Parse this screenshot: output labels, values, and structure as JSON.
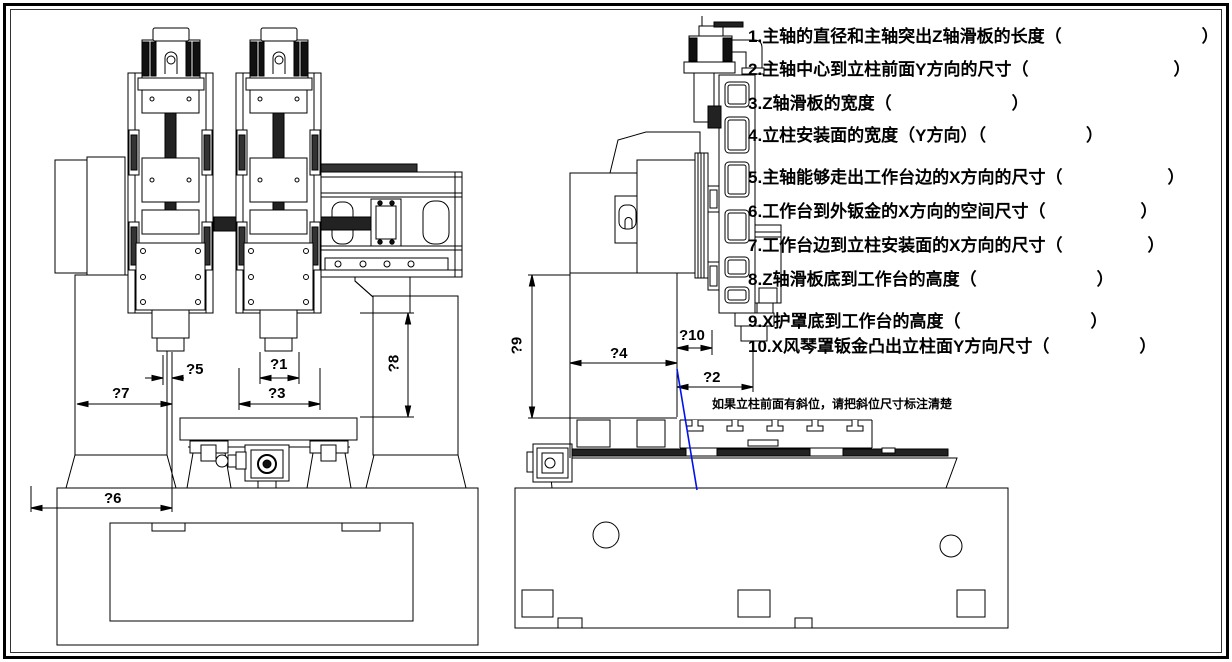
{
  "drawing": {
    "note": "如果立柱前面有斜位，请把斜位尺寸标注清楚",
    "line_color": "#000000",
    "slope_line_color": "#0011ee",
    "background": "#ffffff"
  },
  "questions": {
    "items": [
      {
        "num": "1.",
        "text": "主轴的直径和主轴突出Z轴滑板的长度",
        "open": "（",
        "close": "）"
      },
      {
        "num": "2.",
        "text": "主轴中心到立柱前面Y方向的尺寸",
        "open": "（",
        "close": "）"
      },
      {
        "num": "3.",
        "text": "Z轴滑板的宽度",
        "open": "（",
        "close": "）"
      },
      {
        "num": "4.",
        "text": "立柱安装面的宽度（Y方向）",
        "open": "（",
        "close": "）"
      },
      {
        "num": "5.",
        "text": "主轴能够走出工作台边的X方向的尺寸",
        "open": "（",
        "close": "）"
      },
      {
        "num": "6.",
        "text": "工作台到外钣金的X方向的空间尺寸",
        "open": "（",
        "close": "）"
      },
      {
        "num": "7.",
        "text": "工作台边到立柱安装面的X方向的尺寸",
        "open": "（",
        "close": "）"
      },
      {
        "num": "8.",
        "text": "Z轴滑板底到工作台的高度",
        "open": "（",
        "close": "）"
      },
      {
        "num": "9.",
        "text": "X护罩底到工作台的高度",
        "open": "（",
        "close": "）"
      },
      {
        "num": "10.",
        "text": "X风琴罩钣金凸出立柱面Y方向尺寸",
        "open": "（",
        "close": "）"
      }
    ]
  },
  "dims": {
    "d1": "?1",
    "d2": "?2",
    "d3": "?3",
    "d4": "?4",
    "d5": "?5",
    "d6": "?6",
    "d7": "?7",
    "d8": "?8",
    "d9": "?9",
    "d10": "?10"
  }
}
